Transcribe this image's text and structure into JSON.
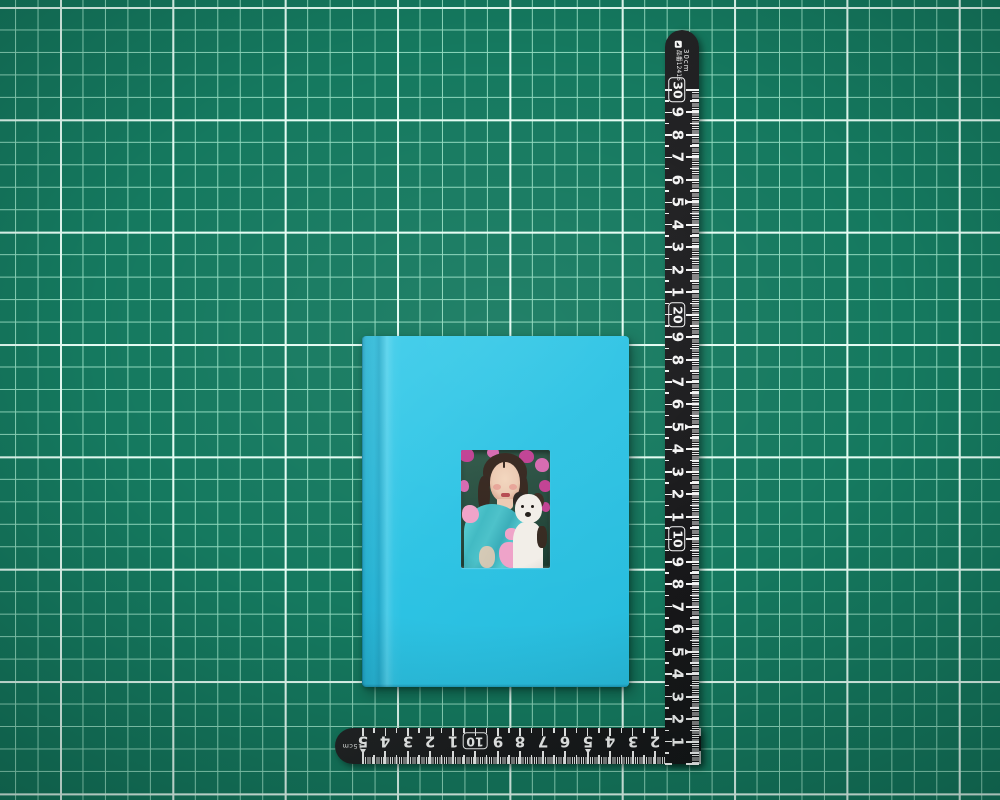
{
  "colors": {
    "mat_base": "#15795f",
    "mat_minor_line": "#8ed8bd",
    "mat_major_line": "#e4fcf3",
    "ruler_body": "#1a1a1c",
    "ruler_marking": "#f4f4f4",
    "book_cover": "#2dc3e4",
    "book_cover_light": "#3fcdea",
    "photo_bg": "#24493c",
    "heart": "#c03f92",
    "heart_light": "#d668b0",
    "skin": "#eccab2",
    "cheek": "#e59a90",
    "lip": "#b5494f",
    "hair": "#34251d",
    "dress": "#4ac1c9",
    "bow": "#efa2c8",
    "dog_white": "#f2eee8",
    "dog_dark": "#2a2420"
  },
  "icons": {
    "brand_logo": "shinwa-logo-mark"
  },
  "vertical_ruler": {
    "length_label": "30cm",
    "product_code": "品番12416",
    "marks": [
      {
        "cm": 30,
        "label": "30",
        "boxed": true
      },
      {
        "cm": 29,
        "label": "9"
      },
      {
        "cm": 28,
        "label": "8"
      },
      {
        "cm": 27,
        "label": "7"
      },
      {
        "cm": 26,
        "label": "6"
      },
      {
        "cm": 25,
        "label": "5",
        "arrow": true
      },
      {
        "cm": 24,
        "label": "4"
      },
      {
        "cm": 23,
        "label": "3"
      },
      {
        "cm": 22,
        "label": "2"
      },
      {
        "cm": 21,
        "label": "1"
      },
      {
        "cm": 20,
        "label": "20",
        "boxed": true
      },
      {
        "cm": 19,
        "label": "9"
      },
      {
        "cm": 18,
        "label": "8"
      },
      {
        "cm": 17,
        "label": "7"
      },
      {
        "cm": 16,
        "label": "6"
      },
      {
        "cm": 15,
        "label": "5",
        "arrow": true
      },
      {
        "cm": 14,
        "label": "4"
      },
      {
        "cm": 13,
        "label": "3"
      },
      {
        "cm": 12,
        "label": "2"
      },
      {
        "cm": 11,
        "label": "1"
      },
      {
        "cm": 10,
        "label": "10",
        "boxed": true
      },
      {
        "cm": 9,
        "label": "9"
      },
      {
        "cm": 8,
        "label": "8"
      },
      {
        "cm": 7,
        "label": "7"
      },
      {
        "cm": 6,
        "label": "6"
      },
      {
        "cm": 5,
        "label": "5",
        "arrow": true
      },
      {
        "cm": 4,
        "label": "4"
      },
      {
        "cm": 3,
        "label": "3"
      },
      {
        "cm": 2,
        "label": "2"
      },
      {
        "cm": 1,
        "label": "1"
      }
    ]
  },
  "horizontal_ruler": {
    "length_label": "15cm",
    "marks": [
      {
        "cm": 15,
        "label": "5",
        "arrow": true
      },
      {
        "cm": 14,
        "label": "4"
      },
      {
        "cm": 13,
        "label": "3"
      },
      {
        "cm": 12,
        "label": "2"
      },
      {
        "cm": 11,
        "label": "1"
      },
      {
        "cm": 10,
        "label": "10",
        "boxed": true
      },
      {
        "cm": 9,
        "label": "9"
      },
      {
        "cm": 8,
        "label": "8"
      },
      {
        "cm": 7,
        "label": "7"
      },
      {
        "cm": 6,
        "label": "6"
      },
      {
        "cm": 5,
        "label": "5",
        "arrow": true
      },
      {
        "cm": 4,
        "label": "4"
      },
      {
        "cm": 3,
        "label": "3"
      },
      {
        "cm": 2,
        "label": "2"
      },
      {
        "cm": 1,
        "label": "1"
      }
    ]
  }
}
